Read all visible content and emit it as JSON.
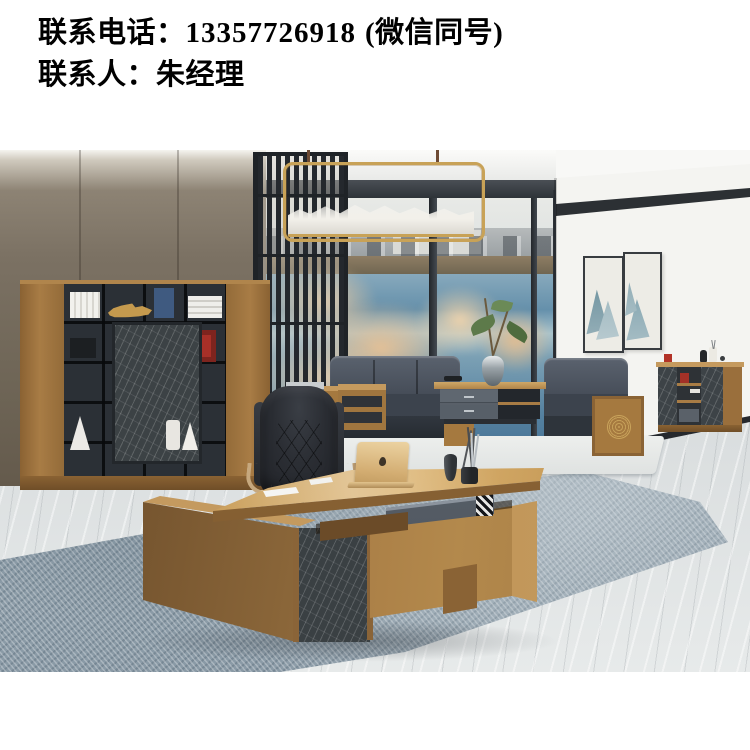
{
  "contact": {
    "phone_label": "联系电话：",
    "phone_number": "13357726918",
    "phone_note": "(微信同号)",
    "person_label": "联系人：",
    "person_name": "朱经理"
  },
  "scene": {
    "setting": "modern executive office furniture showroom photo",
    "items": [
      "wood-bookcase",
      "slat-partition-screen",
      "gold-pendant-lamp",
      "window-lake-view",
      "wall-art-diptych",
      "side-cabinet",
      "leather-sofa-set",
      "coffee-table",
      "executive-chair",
      "l-shaped-executive-desk",
      "gold-laptop",
      "blue-area-rug",
      "marble-floor"
    ]
  },
  "colors": {
    "background": "#ffffff",
    "text": "#000000",
    "wood": "#a87c45",
    "dark_marble": "#3c4245",
    "wall_taupe": "#7b7163",
    "water_blue": "#5c88a6",
    "rug_blue": "#8fa0ab",
    "lamp_gold": "#c8a257",
    "leather_dark": "#26292e",
    "accent_red": "#a83028"
  }
}
